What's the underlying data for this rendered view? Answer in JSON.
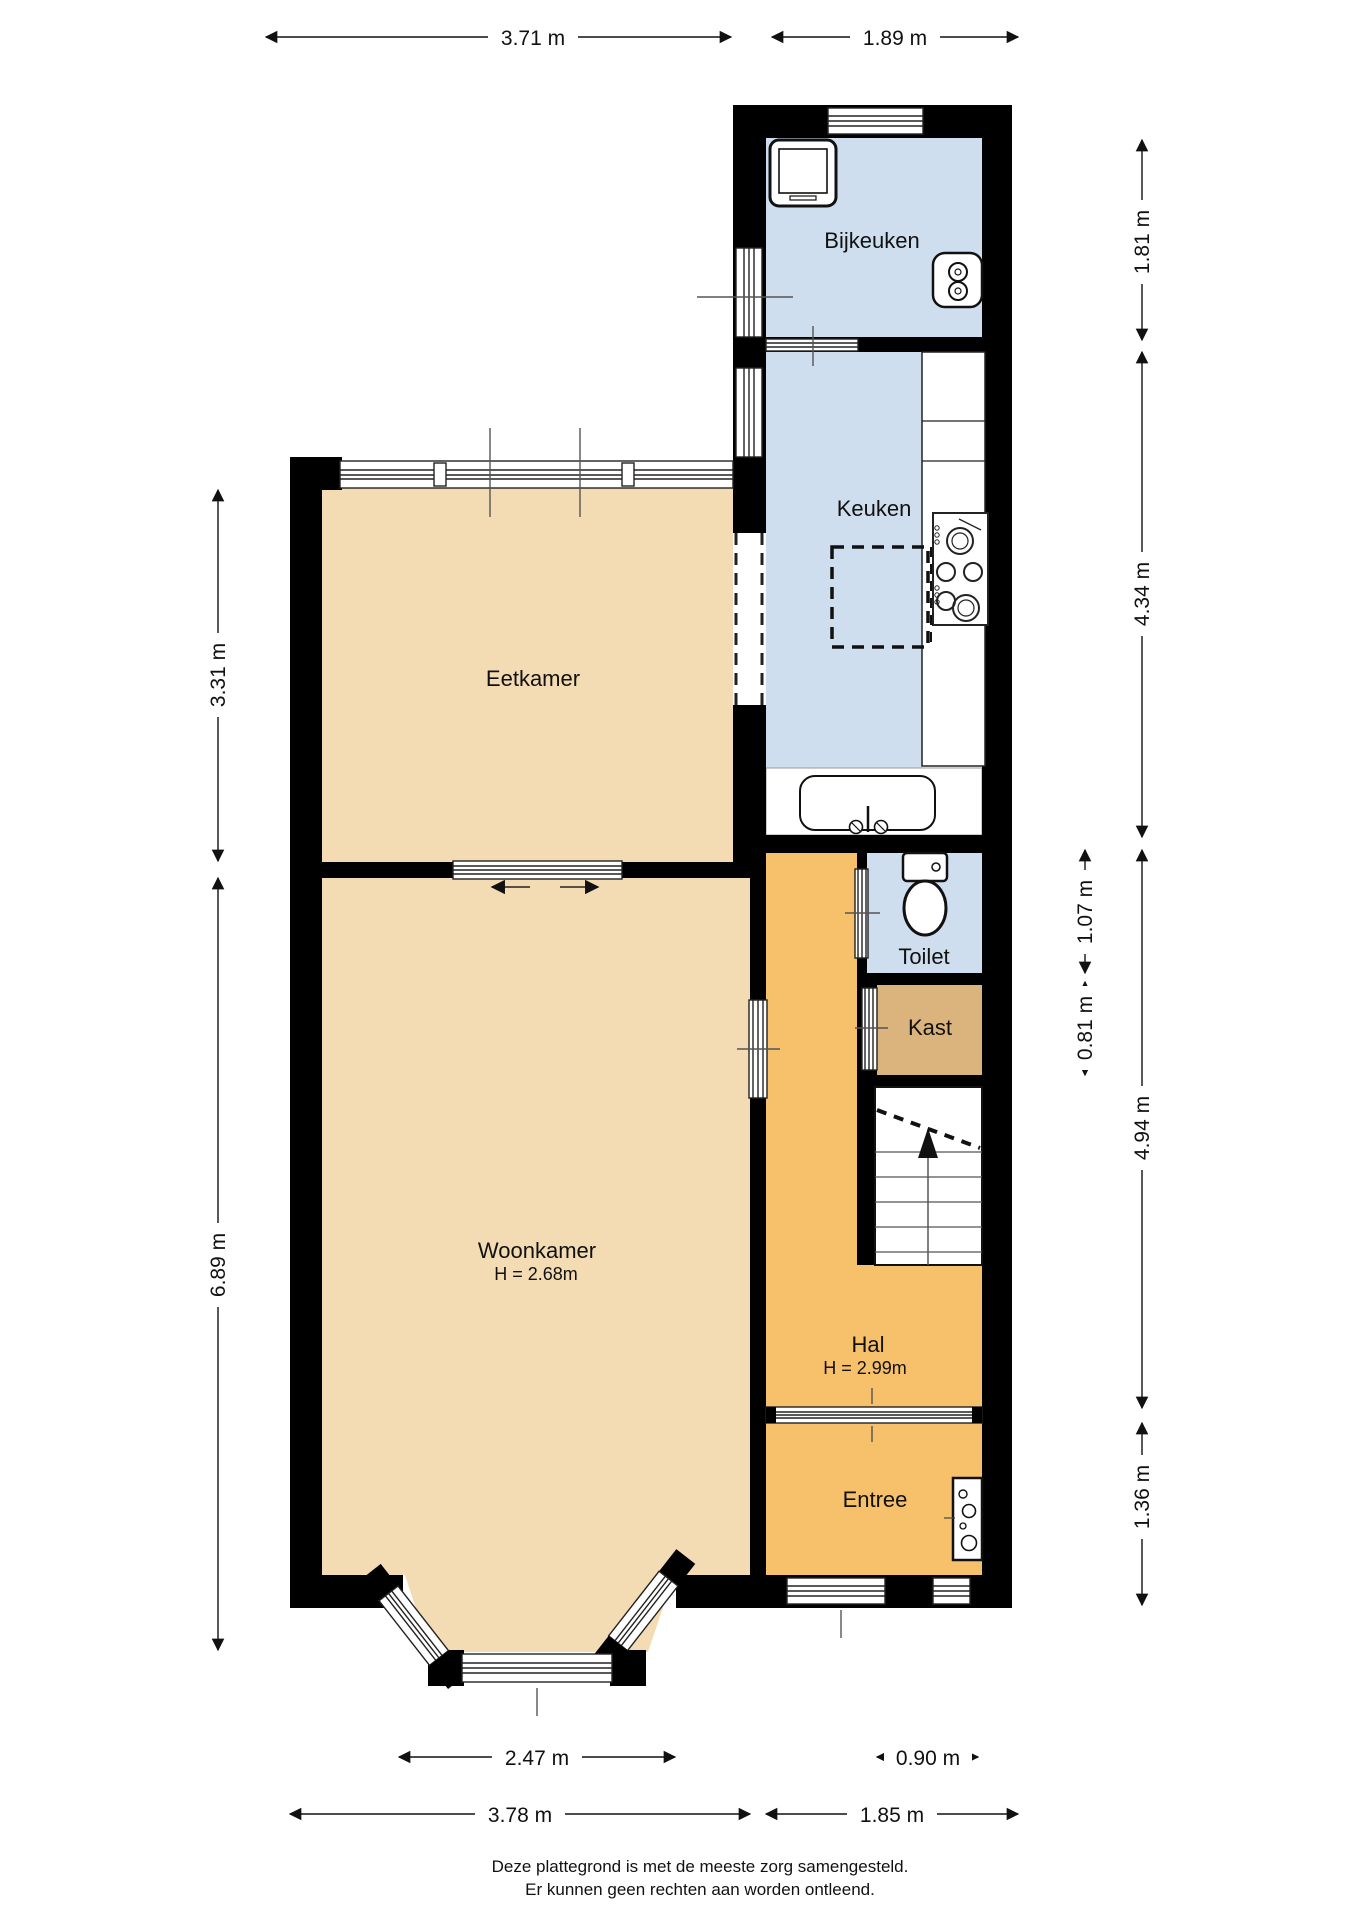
{
  "labels": {
    "bijkeuken": "Bijkeuken",
    "keuken": "Keuken",
    "eetkamer": "Eetkamer",
    "toilet": "Toilet",
    "kast": "Kast",
    "woonkamer": "Woonkamer",
    "woonkamer_height": "H = 2.68m",
    "hal": "Hal",
    "hal_height": "H = 2.99m",
    "entree": "Entree"
  },
  "dimensions": {
    "top_width_left": "3.71 m",
    "top_width_right": "1.89 m",
    "right_bijkeuken": "1.81 m",
    "right_keuken": "4.34 m",
    "right_toilet": "1.07 m",
    "right_kast": "0.81 m",
    "right_hal": "4.94 m",
    "right_entree": "1.36 m",
    "left_eetkamer": "3.31 m",
    "left_woonkamer": "6.89 m",
    "bottom_bay": "2.47 m",
    "bottom_door": "0.90 m",
    "bottom_width_left": "3.78 m",
    "bottom_width_right": "1.85 m"
  },
  "footer": {
    "line1": "Deze plattegrond is met de meeste zorg samengesteld.",
    "line2": "Er kunnen geen rechten aan worden ontleend."
  },
  "colors": {
    "room_tan": "#f3dcb3",
    "room_orange": "#f7c06a",
    "room_blue": "#cfdeee",
    "room_brown": "#dbb37c",
    "wall": "#000000"
  },
  "icons": [
    "washing-machine-icon",
    "boiler-icon",
    "stove-icon",
    "bathtub-icon",
    "toilet-icon",
    "meter-cupboard-icon",
    "stairs-icon"
  ]
}
